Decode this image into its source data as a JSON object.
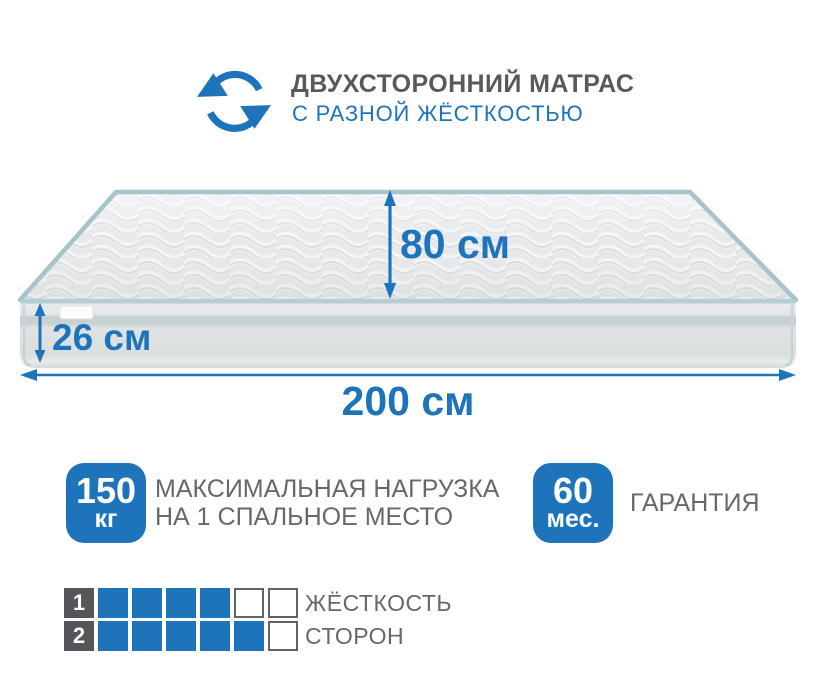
{
  "colors": {
    "accent_blue": "#1e74bb",
    "text_gray": "#58595b",
    "label_gray": "#66686b"
  },
  "header": {
    "icon": "rotate-arrows-icon",
    "title": "ДВУХСТОРОННИЙ МАТРАС",
    "subtitle": "С РАЗНОЙ ЖЁСТКОСТЬЮ"
  },
  "mattress": {
    "depth_label": "80 см",
    "height_label": "26 см",
    "width_label": "200 см"
  },
  "features": [
    {
      "badge_value": "150",
      "badge_unit": "кг",
      "label_line1": "МАКСИМАЛЬНАЯ НАГРУЗКА",
      "label_line2": "НА 1 СПАЛЬНОЕ МЕСТО"
    },
    {
      "badge_value": "60",
      "badge_unit": "мес.",
      "label": "ГАРАНТИЯ"
    }
  ],
  "firmness_scale": {
    "caption_line1": "ЖЁСТКОСТЬ",
    "caption_line2": "СТОРОН",
    "max": 6,
    "rows": [
      {
        "label": "1",
        "filled": 4,
        "total": 6
      },
      {
        "label": "2",
        "filled": 5,
        "total": 6
      }
    ]
  }
}
